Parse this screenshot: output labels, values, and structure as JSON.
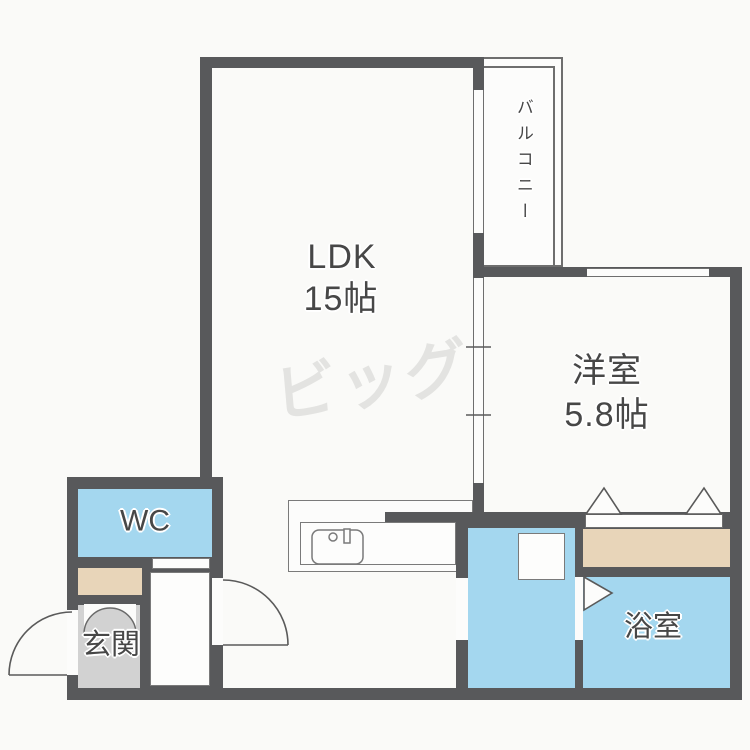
{
  "watermark": {
    "text": "ビッグ"
  },
  "rooms": {
    "ldk": {
      "label": "LDK",
      "size": "15帖"
    },
    "western_room": {
      "label": "洋室",
      "size": "5.8帖"
    },
    "balcony": {
      "label": "バルコニー"
    },
    "wc": {
      "label": "WC"
    },
    "entrance": {
      "label": "玄関"
    },
    "bathroom": {
      "label": "浴室"
    }
  },
  "colors": {
    "wall": "#58595b",
    "wet_room_fill": "#a4d7ef",
    "closet_floor": "#e8d5b9",
    "entrance_floor": "#d2d2d2",
    "watermark": "#e3e3e1",
    "label_text": "#474747"
  }
}
